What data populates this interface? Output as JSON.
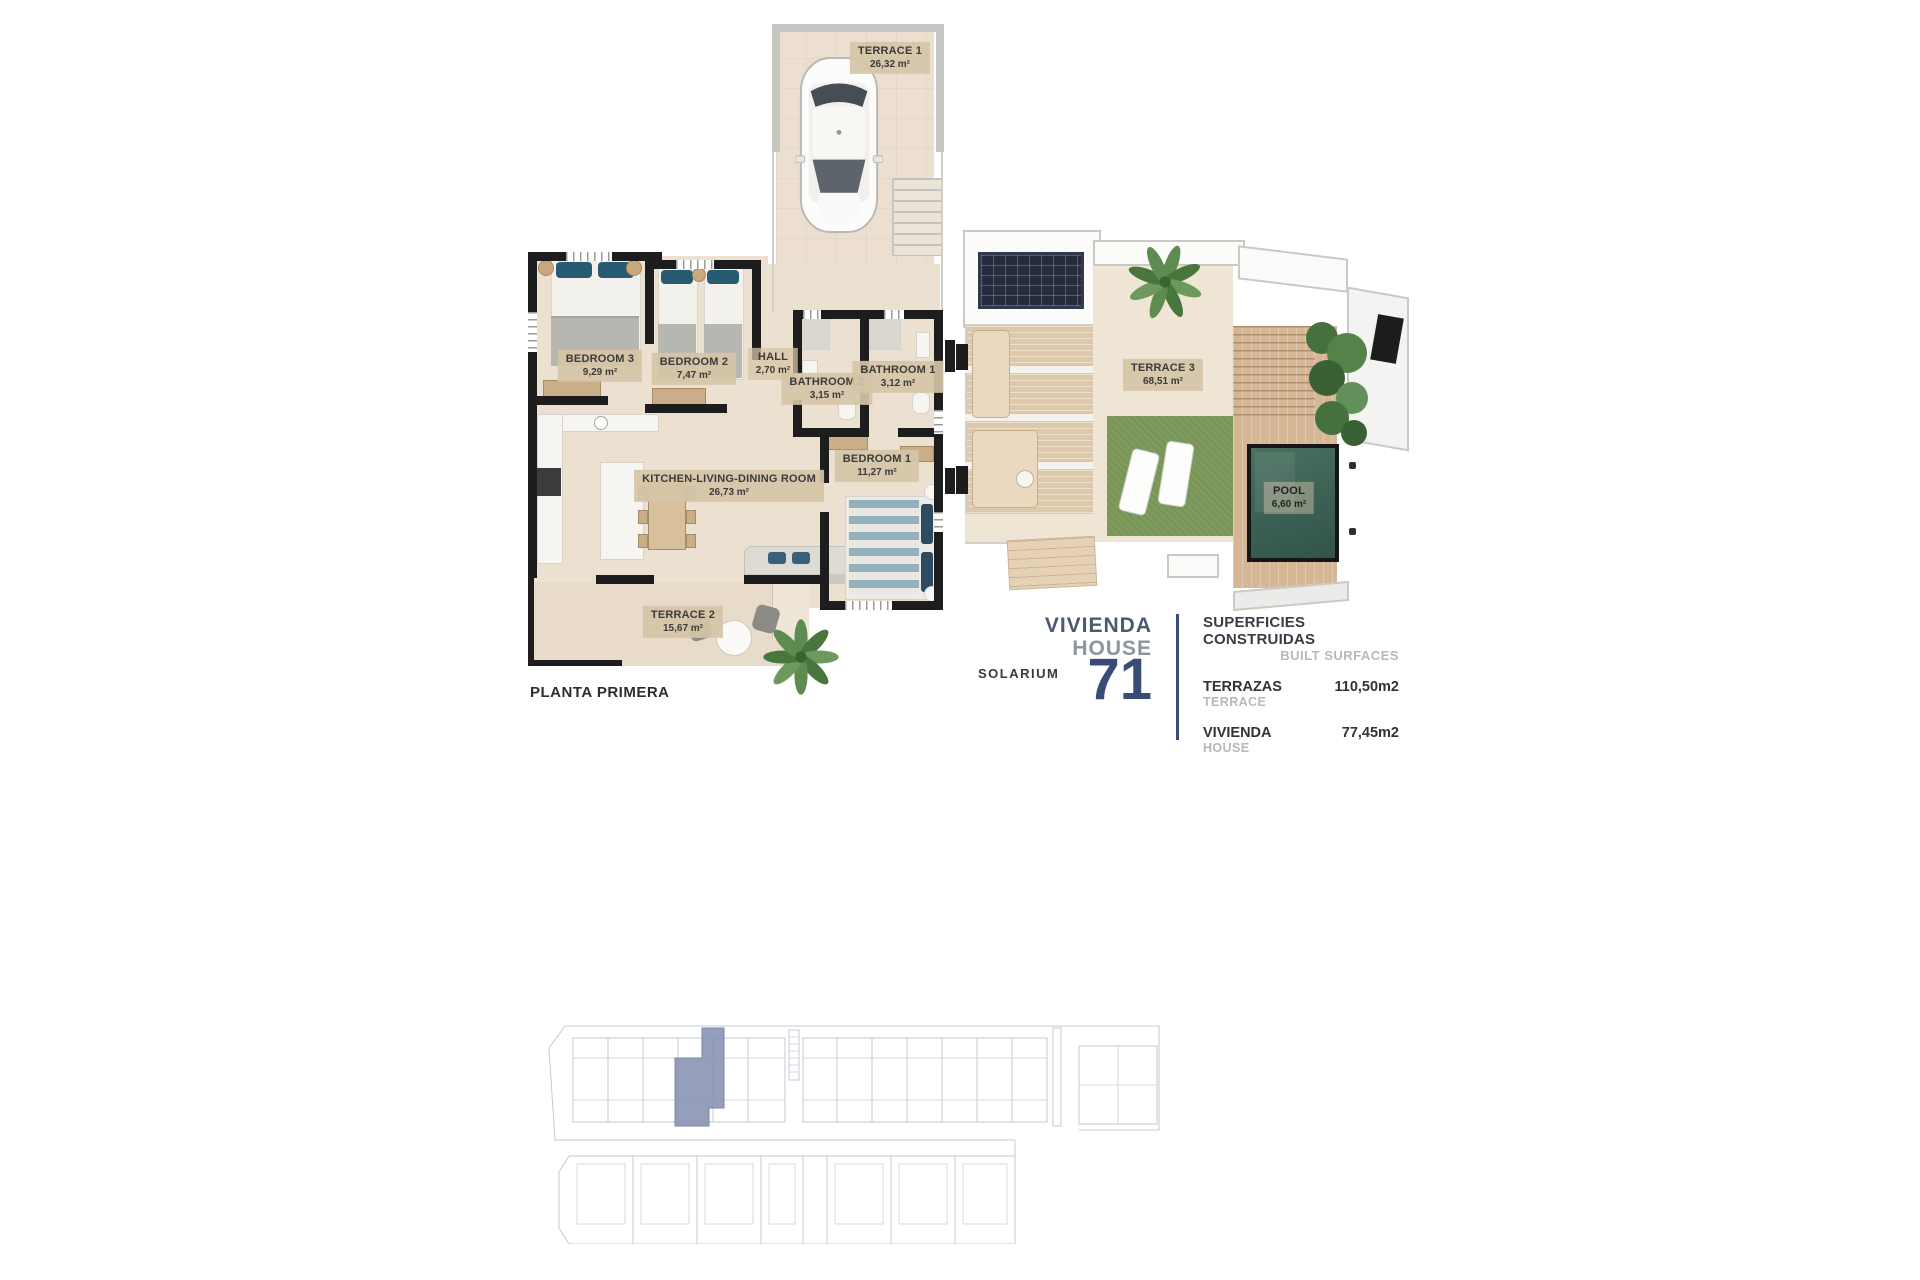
{
  "plan_first_floor": {
    "label": "PLANTA PRIMERA",
    "rooms": [
      {
        "name": "TERRACE 1",
        "area": "26,32 m²"
      },
      {
        "name": "BEDROOM 3",
        "area": "9,29 m²"
      },
      {
        "name": "BEDROOM 2",
        "area": "7,47 m²"
      },
      {
        "name": "HALL",
        "area": "2,70 m²"
      },
      {
        "name": "BATHROOM 2",
        "area": "3,15 m²"
      },
      {
        "name": "BATHROOM 1",
        "area": "3,12 m²"
      },
      {
        "name": "BEDROOM 1",
        "area": "11,27 m²"
      },
      {
        "name": "KITCHEN-LIVING-DINING ROOM",
        "area": "26,73 m²"
      },
      {
        "name": "TERRACE 2",
        "area": "15,67 m²"
      }
    ]
  },
  "plan_solarium": {
    "label": "SOLARIUM",
    "rooms": [
      {
        "name": "TERRACE 3",
        "area": "68,51 m²"
      },
      {
        "name": "POOL",
        "area": "6,60 m²"
      }
    ]
  },
  "title_block": {
    "vivienda": "VIVIENDA",
    "house": "HOUSE",
    "number": "71"
  },
  "surfaces": {
    "title_es": "SUPERFICIES CONSTRUIDAS",
    "title_en": "BUILT SURFACES",
    "rows": [
      {
        "label_es": "TERRAZAS",
        "label_en": "TERRACE",
        "value": "110,50m2"
      },
      {
        "label_es": "VIVIENDA",
        "label_en": "HOUSE",
        "value": "77,45m2"
      }
    ]
  },
  "colors": {
    "accent_navy": "#3a4b78",
    "slate": "#4d5a6e",
    "muted_gray": "#8e949d",
    "light_gray": "#b8b8b5",
    "highlight_blue": "#8a95b5",
    "wall_black": "#1d1d1d",
    "floor_cream": "#ece1d1",
    "label_tan": "#d5c3a6",
    "pool_teal": "#41675c",
    "grass_green": "#7e9b5d"
  }
}
